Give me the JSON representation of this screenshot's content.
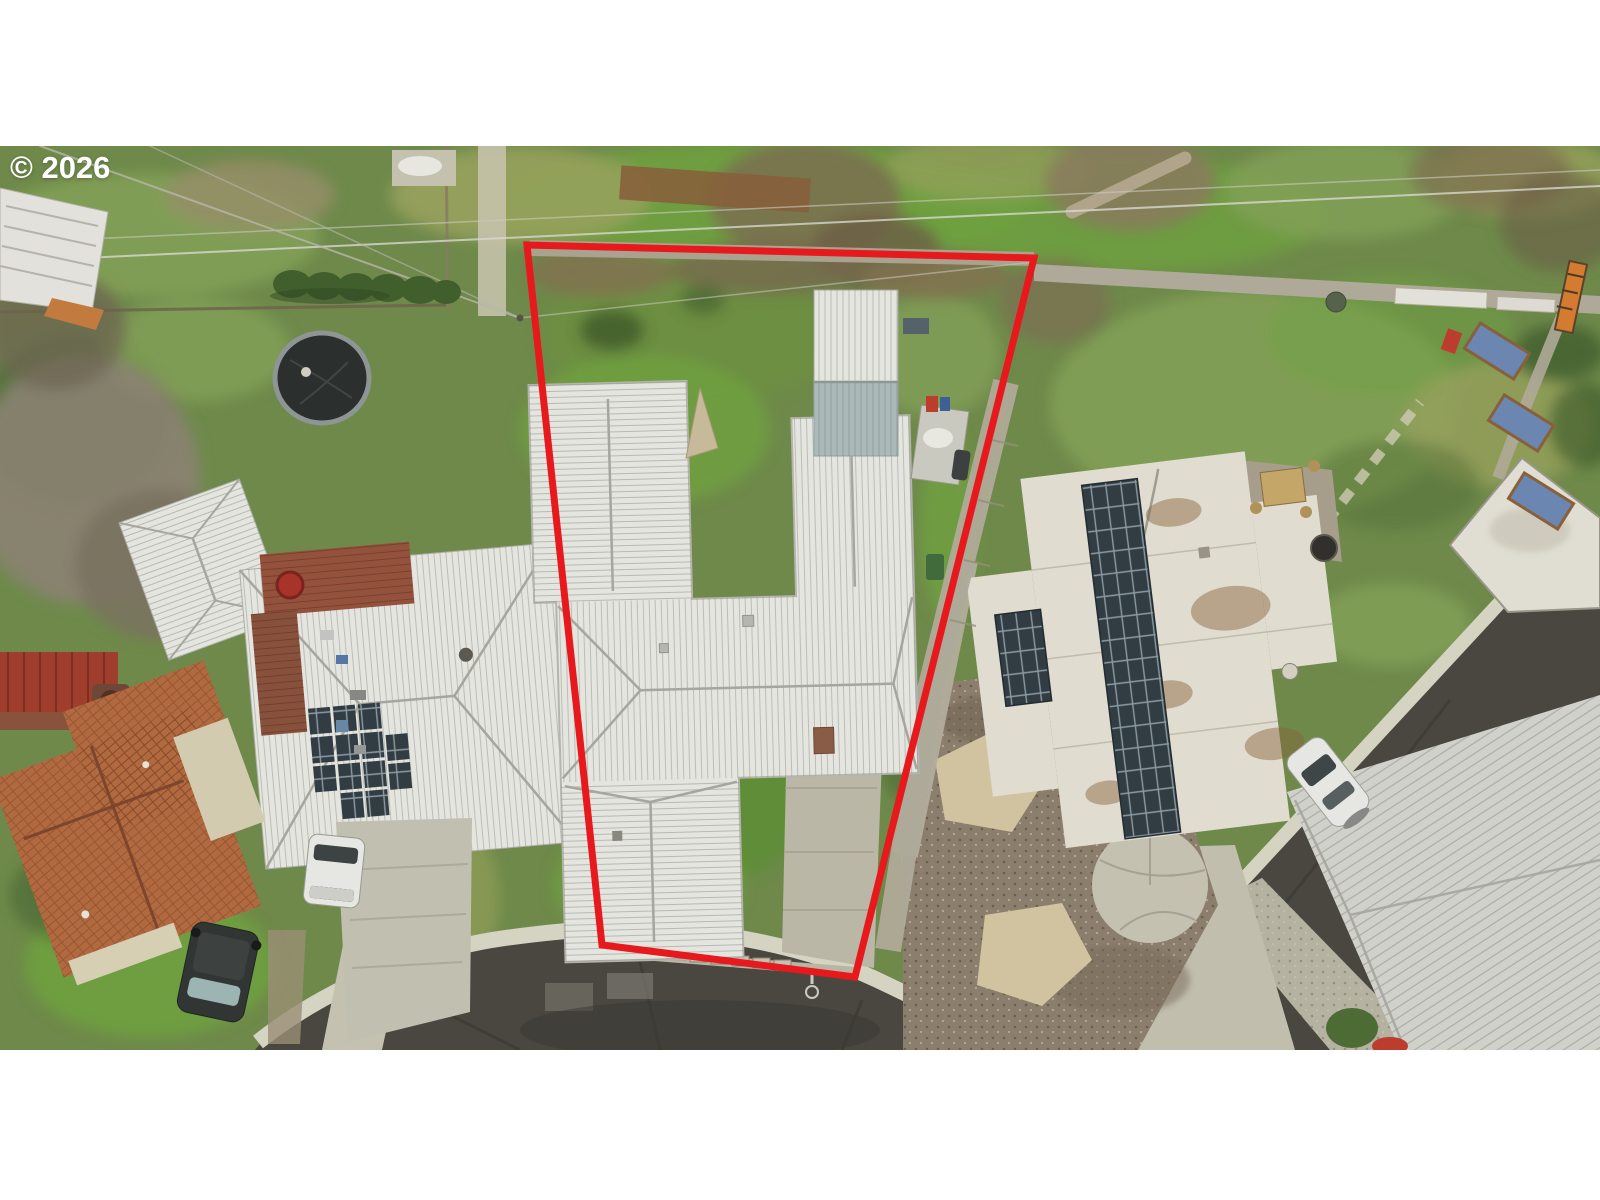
{
  "meta": {
    "type": "aerial-drone-photo",
    "description": "Overhead drone photo of a residential cul-de-sac lot; the subject property is outlined with a red boundary line. Winter lawns, white metal roofs, solar panels, driveways and parked cars are visible. White letterbox bars frame the photo top and bottom."
  },
  "watermark": {
    "text": "© 2026"
  },
  "boundary": {
    "points_attr": "527,245 1034,258 855,977 602,945",
    "stroke_width": 7
  },
  "scene": {
    "features": [
      "subject lot outlined in red",
      "white metal cross-hip roof house with detached two-tone shed",
      "concrete driveway to cul-de-sac street",
      "left neighbor house with rooftop solar panels and wood deck",
      "terracotta tile roof house at lower left",
      "right neighbor house with flat white roof and long solar array",
      "gravel front yard with paver islands and flagstone circle",
      "trampoline in rear neighbor yard",
      "dark SUV, white van and white sedan parked",
      "curved asphalt cul-de-sac and side street",
      "power lines crossing rear yards"
    ]
  },
  "palette": {
    "letterbox": "#ffffff",
    "watermark": "#ffffff",
    "boundary-red": "#e7191c",
    "grass-base": "#6e8a49",
    "grass-bright": "#6fa33d",
    "grass-light": "#85a258",
    "grass-olive": "#99a35c",
    "grass-dark": "#4d6a34",
    "asphalt": "#47443f",
    "asphalt-dark": "#35332f",
    "concrete": "#c4bfae",
    "concrete-light": "#d7d3c4",
    "concrete-stain": "#aaa393",
    "curb": "#dbd7c8",
    "gravel": "#8e7e6e",
    "paver-tan": "#d7c7a4",
    "roof-white": "#ebeae7",
    "roof-line": "#a9a7a2",
    "flat-roof": "#e6e1d6",
    "rust": "#8a6038",
    "solar-dark": "#2f3942",
    "tile-orange": "#b5683f",
    "cream": "#d9cfb4",
    "deck-red": "#96503c",
    "pergola-red": "#a33a2c",
    "hedge": "#3f5d2b",
    "twig": "#8c8273",
    "brush-brown": "#82714f",
    "mulch": "#6b4a33",
    "wall-gray": "#aca491",
    "shed-blue": "#aebcbe",
    "suv-dark": "#2e3233",
    "car-white": "#ececea",
    "tarp-blue": "#6b86b5"
  }
}
